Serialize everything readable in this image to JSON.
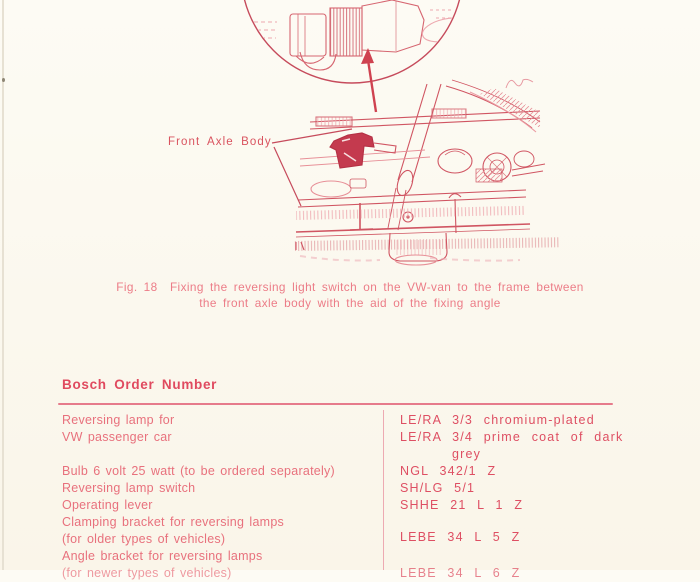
{
  "page": {
    "background": "#fbf8ee",
    "ink_heading": "#e04a5f",
    "ink_body": "#e8717d",
    "ink_numbers": "#de4f63",
    "ink_drawing": "#d05562"
  },
  "figure": {
    "axle_label": "Front Axle Body",
    "caption_line1": "Fig. 18  Fixing the reversing light switch on the VW-van to the frame between",
    "caption_line2": "the front axle body with the aid of the fixing angle"
  },
  "order_section": {
    "heading": "Bosch Order Number",
    "rows": [
      {
        "item": [
          "Reversing lamp for",
          "VW passenger car"
        ],
        "numbers": [
          "LE/RA 3/3 chromium-plated",
          "LE/RA 3/4 prime coat of dark",
          "grey"
        ]
      },
      {
        "item": [
          "Bulb 6 volt 25 watt (to be ordered separately)"
        ],
        "numbers": [
          "NGL 342/1 Z"
        ]
      },
      {
        "item": [
          "Reversing lamp switch"
        ],
        "numbers": [
          "SH/LG 5/1"
        ]
      },
      {
        "item": [
          "Operating lever"
        ],
        "numbers": [
          "SHHE 21 L 1 Z"
        ]
      },
      {
        "item": [
          "Clamping bracket for reversing lamps",
          "(for older types of vehicles)"
        ],
        "numbers": [
          "LEBE 34 L 5 Z"
        ]
      },
      {
        "item": [
          "Angle bracket for reversing lamps"
        ],
        "numbers": []
      },
      {
        "item": [
          "(for newer types of vehicles)"
        ],
        "numbers": [
          "LEBE 34 L 6 Z"
        ]
      }
    ]
  }
}
